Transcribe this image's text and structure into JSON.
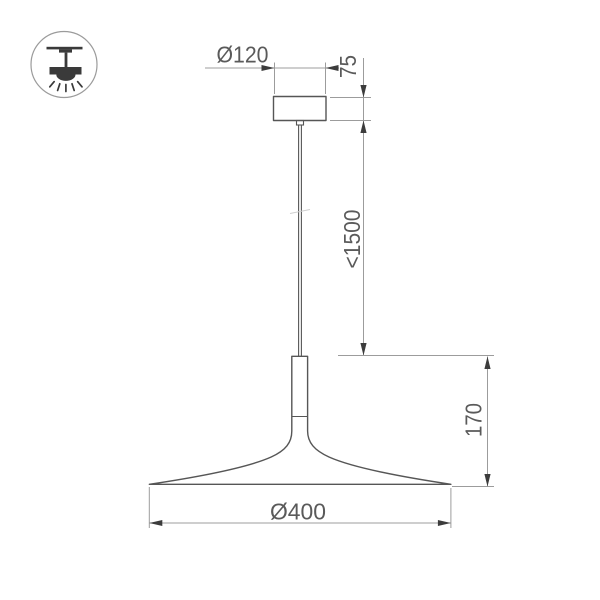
{
  "drawing": {
    "subject": "pendant-lamp-dimension-drawing",
    "dimensions": {
      "canopy_diameter": "Ø120",
      "canopy_height": "75",
      "max_suspension": "<1500",
      "shade_height": "170",
      "shade_diameter": "Ø400"
    },
    "colors": {
      "background": "#ffffff",
      "object_outline": "#565656",
      "dimension_line": "#9c9c9c",
      "arrowhead": "#3c3c3c",
      "dimension_text": "#5a5a5a",
      "icon_glyph": "#3a3a3a",
      "icon_circle": "#9b9b9b"
    }
  }
}
